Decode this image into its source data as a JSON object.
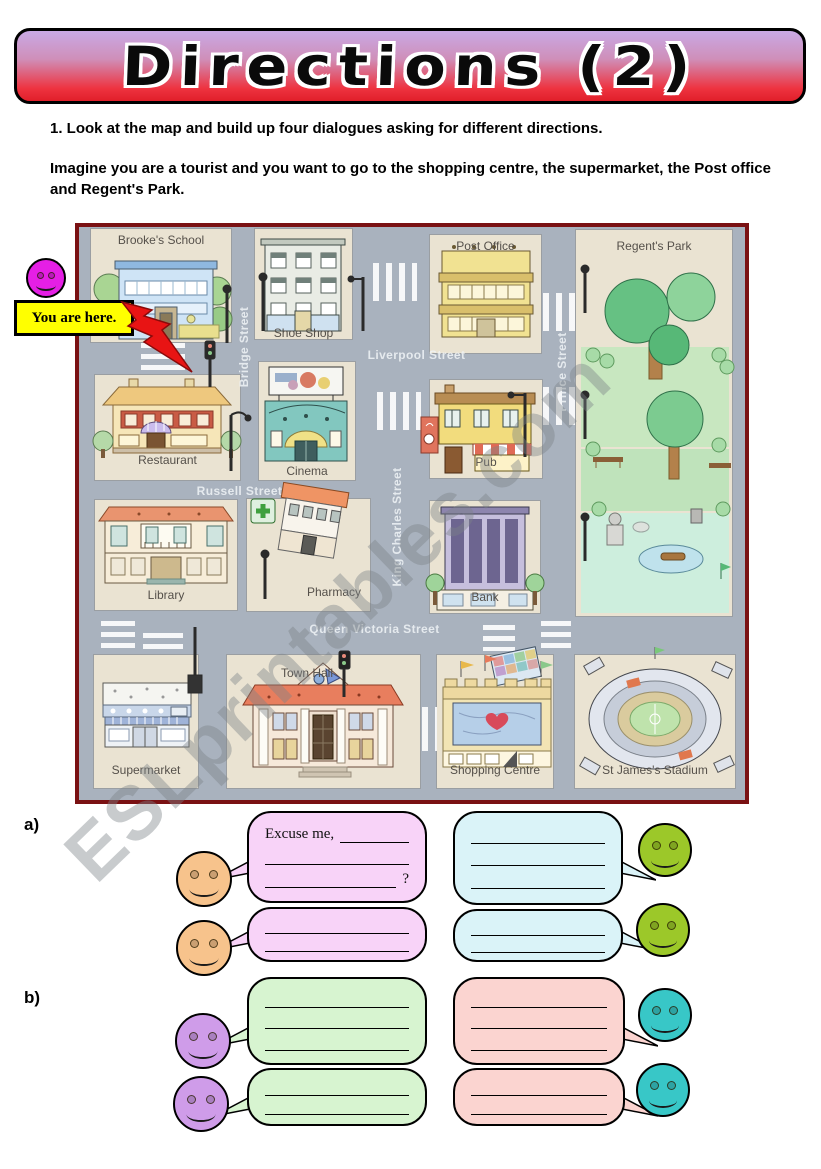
{
  "title": "Directions (2)",
  "instructions": {
    "step1": "1.  Look at the map and build up four dialogues asking for different directions.",
    "intro": "Imagine you are a tourist and you want to go to the shopping centre, the supermarket, the Post office and Regent's Park."
  },
  "you_are_here": {
    "label": "You are here."
  },
  "watermark": "ESLprintables.com",
  "map": {
    "streets": [
      {
        "name": "Bridge Street",
        "orientation": "vertical"
      },
      {
        "name": "Liverpool Street",
        "orientation": "horizontal"
      },
      {
        "name": "King Charles Street",
        "orientation": "vertical"
      },
      {
        "name": "Prince Street",
        "orientation": "vertical"
      },
      {
        "name": "Russell Street",
        "orientation": "horizontal"
      },
      {
        "name": "Queen Victoria Street",
        "orientation": "horizontal"
      }
    ],
    "buildings": [
      {
        "label": "Brooke's School"
      },
      {
        "label": "Shoe Shop"
      },
      {
        "label": "Post Office"
      },
      {
        "label": "Regent's Park"
      },
      {
        "label": "Restaurant"
      },
      {
        "label": "Cinema"
      },
      {
        "label": "Pub"
      },
      {
        "label": "Library"
      },
      {
        "label": "Pharmacy"
      },
      {
        "label": "Bank"
      },
      {
        "label": "Supermarket"
      },
      {
        "label": "Town Hall"
      },
      {
        "label": "Shopping Centre"
      },
      {
        "label": "St James's Stadium"
      }
    ]
  },
  "dialogues": {
    "section_a_label": "a)",
    "section_b_label": "b)",
    "prompt_prefix": "Excuse me,",
    "question_mark": "?"
  },
  "colors": {
    "banner_top": "#c9a9e5",
    "banner_bottom": "#e01f2a",
    "you_are_here_bg": "#ffff00",
    "arrow_red": "#e81414",
    "smiley_magenta": "#e51fe5",
    "smiley_orange": "#f7c38c",
    "smiley_green": "#9cc829",
    "smiley_purple": "#cf9ce9",
    "smiley_teal": "#38c7c7",
    "bubble_pink": "#f8d3f8",
    "bubble_cyan": "#daf3f8",
    "bubble_green": "#d7f4d0",
    "bubble_salmon": "#fbd4d0",
    "map_street": "#a9b2be",
    "map_block": "#eae3d2",
    "map_border": "#7a1113"
  }
}
